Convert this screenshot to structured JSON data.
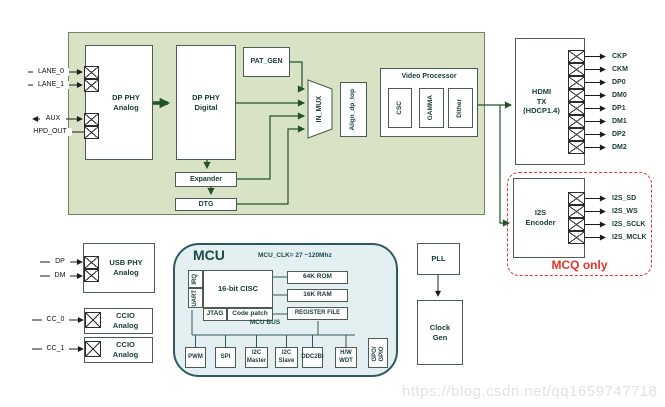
{
  "watermark": "https://blog.csdn.net/qq1659747718",
  "colors": {
    "board_fill": "#d8e2c4",
    "mcu_fill": "#e4eff2",
    "accent_red": "#e8332a",
    "line_green": "#24512e"
  },
  "pins": {
    "lane0": "LANE_0",
    "lane1": "LANE_1",
    "aux": "AUX",
    "hpd_out": "HPD_OUT",
    "dp": "DP",
    "dm": "DM",
    "cc0": "CC_0",
    "cc1": "CC_1"
  },
  "blocks": {
    "dp_phy_analog": {
      "l1": "DP PHY",
      "l2": "Analog"
    },
    "dp_phy_digital": {
      "l1": "DP PHY",
      "l2": "Digital"
    },
    "pat_gen": "PAT_GEN",
    "in_mux": "IN_MUX",
    "align_dp_top": "Align_dp_top",
    "video_processor": {
      "title": "Video Processor",
      "modules": [
        "CSC",
        "GAMMA",
        "Dither"
      ]
    },
    "expander": "Expander",
    "dtg": "DTG",
    "hdmi_tx": {
      "l1": "HDMI",
      "l2": "TX",
      "l3": "(HDCP1.4)"
    },
    "i2s_encoder": {
      "l1": "I2S",
      "l2": "Encoder"
    },
    "usb_phy": {
      "l1": "USB PHY",
      "l2": "Analog"
    },
    "ccio_0": {
      "l1": "CCIO",
      "l2": "Analog"
    },
    "ccio_1": {
      "l1": "CCIO",
      "l2": "Analog"
    },
    "pll": "PLL",
    "clock_gen": {
      "l1": "Clock",
      "l2": "Gen"
    }
  },
  "hdmi_outputs": [
    "CKP",
    "CKM",
    "DP0",
    "DM0",
    "DP1",
    "DM1",
    "DP2",
    "DM2"
  ],
  "i2s_outputs": [
    "I2S_SD",
    "I2S_WS",
    "I2S_SCLK",
    "I2S_MCLK"
  ],
  "mcq_only_label": "MCQ only",
  "mcu": {
    "title": "MCU",
    "clock_note": "MCU_CLK= 27 ~120Mhz",
    "irq": "IRQ",
    "uart": "UART",
    "cisc": "16-bit CISC",
    "jtag": "JTAG",
    "code_patch": "Code patch",
    "rom": "64K ROM",
    "ram": "16K RAM",
    "register_file": "REGISTER FILE",
    "bus_label": "MCU BUS",
    "peripherals": [
      {
        "l1": "PWM",
        "l2": ""
      },
      {
        "l1": "SPI",
        "l2": ""
      },
      {
        "l1": "I2C",
        "l2": "Master"
      },
      {
        "l1": "I2C",
        "l2": "Slave"
      },
      {
        "l1": "DDC2Bi",
        "l2": ""
      },
      {
        "l1": "H/W",
        "l2": "WDT"
      }
    ],
    "gpio": {
      "l1": "GPO/",
      "l2": "GPIO"
    }
  }
}
